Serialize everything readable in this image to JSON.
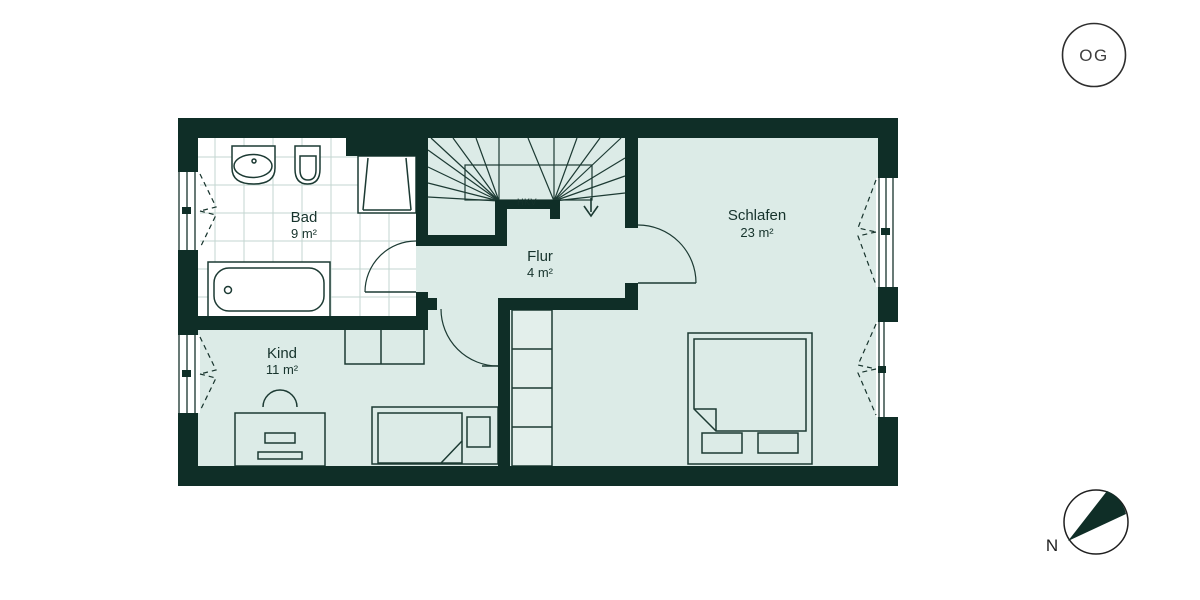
{
  "floor_badge": {
    "label": "OG"
  },
  "compass": {
    "north_label": "N"
  },
  "rooms": {
    "bad": {
      "name": "Bad",
      "area": "9 m²"
    },
    "flur": {
      "name": "Flur",
      "area": "4 m²"
    },
    "kind": {
      "name": "Kind",
      "area": "11 m²"
    },
    "schlafen": {
      "name": "Schlafen",
      "area": "23 m²"
    }
  },
  "stairs": {
    "niche_label": "HKV",
    "direction": "down"
  },
  "colors": {
    "wall": "#0f2e27",
    "floor": "#dcebe7",
    "tile": "#ffffff",
    "tile_grid": "#c3d6d0",
    "outline": "#1c3a33",
    "text": "#16332c"
  }
}
